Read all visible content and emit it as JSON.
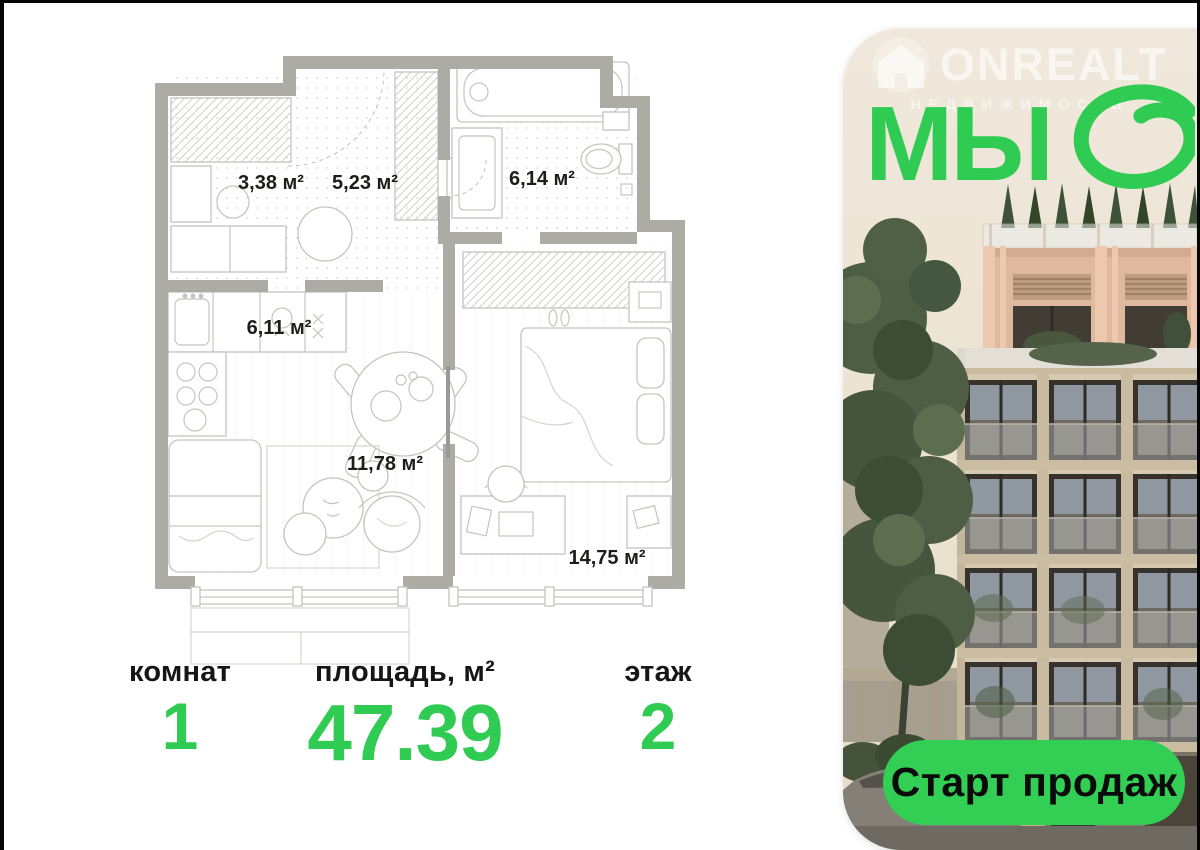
{
  "listing": {
    "floorplan": {
      "rooms": [
        {
          "name": "hallway",
          "area": "3,38 м²"
        },
        {
          "name": "corridor",
          "area": "5,23 м²"
        },
        {
          "name": "bathroom",
          "area": "6,14 м²"
        },
        {
          "name": "kitchen",
          "area": "6,11 м²"
        },
        {
          "name": "living-room",
          "area": "11,78 м²"
        },
        {
          "name": "bedroom",
          "area": "14,75 м²"
        }
      ]
    },
    "stats": {
      "rooms": {
        "label": "комнат",
        "value": "1"
      },
      "area": {
        "label": "площадь, м²",
        "value": "47.39"
      },
      "floor": {
        "label": "этаж",
        "value": "2"
      }
    },
    "promo": {
      "watermark_brand": "ONREALT",
      "watermark_subtitle": "НЕДВИЖИМОСТЬ",
      "project_name": "МЫ",
      "cta": "Старт продаж"
    },
    "colors": {
      "accent_green": "#2fcb52",
      "wall_gray": "#acaca5",
      "card_beige": "#ece4d6",
      "text_dark": "#161616"
    }
  }
}
